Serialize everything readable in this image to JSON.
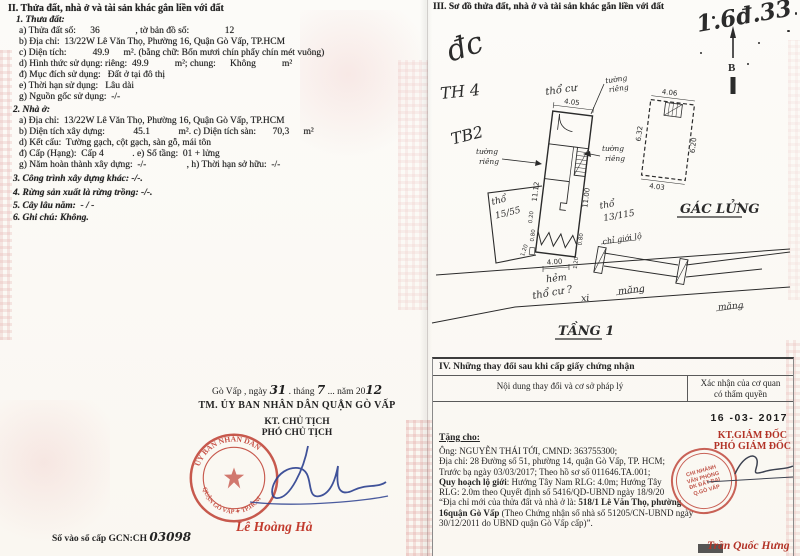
{
  "colors": {
    "stamp_red": "#bf3b2f",
    "ink_blue": "#2a3f8f",
    "name_red": "#c23b2e"
  },
  "left": {
    "s2_title": "II. Thửa đất, nhà ở và tài sản khác gắn liền với đất",
    "land_title": "1. Thưa đất:",
    "land_lines": [
      "a) Thửa đất số:      36               , tờ bản đồ số:               12",
      "b) Địa chỉ:  13/22W Lê Văn Thọ, Phường 16, Quận Gò Vấp, TP.HCM",
      "c) Diện tích:           49.9      m². (bằng chữ: Bốn mươi chín phẩy chín mét vuông)",
      "d) Hình thức sử dụng: riêng:  49.9           m²; chung:      Không           m²",
      "đ) Mục đích sử dụng:   Đất ở tại đô thị",
      "e) Thời hạn sử dụng:   Lâu dài",
      "g) Nguồn gốc sử dụng:  -/-"
    ],
    "house_title": "2. Nhà ở:",
    "house_lines": [
      "a) Địa chỉ:  13/22W Lê Văn Thọ, Phường 16, Quận Gò Vấp, TP.HCM",
      "b) Diện tích xây dựng:            45.1            m². c) Diện tích sàn:       70,3      m²",
      "d) Kết cấu:  Tường gạch, cột gạch, sàn gỗ, mái tôn",
      "đ) Cấp (Hạng):  Cấp 4            . e) Số tầng:  01 + lửng",
      "g) Năm hoàn thành xây dựng:  -/-                 , h) Thời hạn sở hữu:  -/-"
    ],
    "item3": "3. Công trình xây dựng khác: -/-.",
    "item4": "4. Rừng sản xuất là rừng trồng: -/-.",
    "item5": "5. Cây lâu năm:  - / -",
    "item6": "6. Ghi chú: Không."
  },
  "sign": {
    "place": "Gò Vấp ,   ngày",
    "day": "31",
    "m1": ". tháng",
    "month": "7",
    "m2": "... năm 20",
    "year": "12",
    "committee": "TM. ỦY BAN NHÂN DÂN QUẬN GÒ VẤP",
    "kt": "KT. CHỦ TỊCH",
    "deputy": "PHÓ CHỦ TỊCH",
    "name": "Lê Hoàng Hà",
    "stamp_top": "ỦY BAN NHÂN DÂN",
    "stamp_bottom": "QUẬN GÒ VẤP ✦ TP.HCM",
    "book_label": "Số vào sổ cấp GCN:CH",
    "book_value": "03098"
  },
  "s3": {
    "title": "III. Sơ đồ thửa đất, nhà ở và tài sản khác gắn liền với đất",
    "hw_corner": "1.6đ.33",
    "hw_dc": "đc",
    "hw_th4": "TH 4",
    "hw_tb2": "TB2",
    "north": "B",
    "hw_thocu_top": "thổ cư",
    "tuong": "tường",
    "rieng": "riêng",
    "dim_top": "4.05",
    "dim_left": "11.12",
    "dim_right": "11.00",
    "d020": "0.20",
    "d080": "0.80",
    "d120": "1.20",
    "tho": "thổ",
    "no_left": "15/55",
    "no_right": "13/115",
    "chi_gioi": "chỉ giới lộ",
    "dim_alley": "4.00",
    "hem": "hẻm",
    "xi": "xi",
    "mang": "măng",
    "hw_thocu_bottom": "thổ cư ?",
    "floor1": "TẦNG 1",
    "mezz": "GÁC LỬNG",
    "m_top": "4.06",
    "m_left": "6.32",
    "m_right": "6.20",
    "m_bottom": "4.03"
  },
  "s4": {
    "title": "IV. Những thay đổi sau khi cấp giấy chứng nhận",
    "col1": "Nội dung thay đổi và cơ sở pháp lý",
    "col2a": "Xác nhận của cơ quan",
    "col2b": "có thẩm quyền",
    "date": "16 -03- 2017",
    "gift": "Tặng cho:",
    "l1": "Ông: NGUYỄN THÁI TỚI, CMND: 363755300;",
    "l2": "Địa chỉ: 28 Đường số 51, phường 14, quận Gò Vấp, TP. HCM;",
    "l3": "Trước bạ ngày 03/03/2017; Theo hồ sơ số 011646.TA.001;",
    "l4b": "Quy hoạch lộ giới",
    "l4": ": Hướng Tây Nam RLG: 4.0m; Hướng Tây",
    "l5": "RLG: 2.0m theo Quyết định số 5416/QD-UBND ngày 18/9/20",
    "l6": "“Địa chỉ mới của thửa đất và nhà ở là: ",
    "l6b": "518/1 Lê Văn Thọ, phường",
    "l7b": "16quận Gò Vấp ",
    "l7": "(Theo Chứng nhận số nhà số 51205/CN-UBND ngày",
    "l8": "30/12/2011 do UBND quận Gò Vấp cấp)”.",
    "kt": "KT.GIÁM ĐỐC",
    "deputy": "PHÓ GIÁM ĐỐC",
    "name": "Trần Quốc Hưng",
    "stamp": [
      "CHI NHÁNH",
      "VĂN PHÒNG",
      "ĐK ĐẤT ĐAI",
      "Q.GÒ VẤP"
    ]
  }
}
